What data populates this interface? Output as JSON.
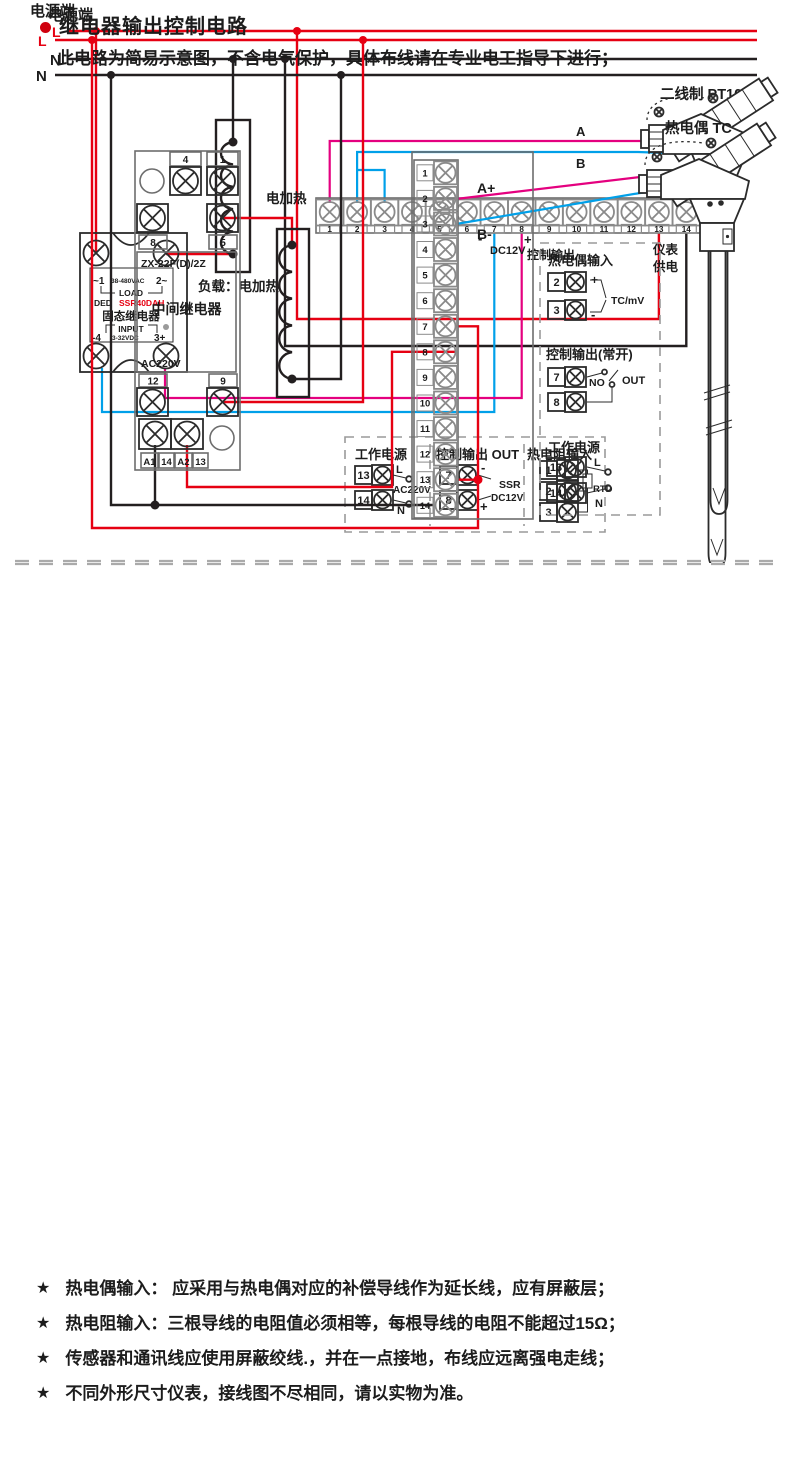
{
  "colors": {
    "live_wire": "#e60012",
    "neutral_wire": "#231f20",
    "plus_wire": "#e4007f",
    "minus_wire": "#00a0e9",
    "model_text": "#e60012",
    "bullet": "#cf000e"
  },
  "diagram1": {
    "power_label": "电源端",
    "line_l": "L",
    "line_n": "N",
    "ssr": {
      "t1": "~1",
      "volt": "38-480VAC",
      "t2": "2~",
      "load": "LOAD",
      "ded": "DED",
      "model": "SSR40DAH",
      "name": "固态继电器",
      "input": "INPUT",
      "t4": "-4",
      "vdc": "3-32VDC",
      "t3": "3+"
    },
    "load_label": "负载：电加热",
    "sensor_label": "二线制 PT100",
    "wire_a": "A",
    "wire_b": "B",
    "minus": "-",
    "plus": "+",
    "dc12v": "DC12V",
    "ctrl_label": "控制输出",
    "meter_supply_1": "仪表",
    "meter_supply_2": "供电",
    "terminals": [
      "1",
      "2",
      "3",
      "4",
      "5",
      "6",
      "7",
      "8",
      "9",
      "10",
      "11",
      "12",
      "13",
      "14"
    ],
    "legend": {
      "title_power": "工作电源",
      "t13": "13",
      "t14": "14",
      "l": "L",
      "n": "N",
      "ac": "AC220V",
      "title_out": "控制输出 OUT",
      "t7": "7",
      "t8": "8",
      "minus": "-",
      "plus": "+",
      "ssr": "SSR",
      "dc12v": "DC12V",
      "title_rtd": "热电阻输入",
      "t1": "1",
      "t2": "2",
      "t3": "3",
      "rtd": "RTD"
    }
  },
  "section2_header": {
    "title": "继电器输出控制电路",
    "subtitle": "此电路为简易示意图，不含电气保护，具体布线请在专业电工指导下进行；"
  },
  "diagram2": {
    "power_label": "电源端",
    "line_l": "L",
    "line_n": "N",
    "relay": {
      "t4": "4",
      "t1": "1",
      "t8": "8",
      "t5": "5",
      "model": "ZX-22F(D)/2Z",
      "name": "中间继电器",
      "volt": "AC220V",
      "t12": "12",
      "t9": "9",
      "a1": "A1",
      "t14": "14",
      "a2": "A2",
      "t13": "13"
    },
    "heater_label": "电加热",
    "a_plus": "A+",
    "b_minus": "B-",
    "sensor_label": "热电偶 TC",
    "terminals": [
      "1",
      "2",
      "3",
      "4",
      "5",
      "6",
      "7",
      "8",
      "9",
      "10",
      "11",
      "12",
      "13",
      "14"
    ],
    "legend": {
      "title_tc": "热电偶输入",
      "t2": "2",
      "t3": "3",
      "plus": "+",
      "minus": "-",
      "tcmv": "TC/mV",
      "title_out": "控制输出(常开)",
      "t7": "7",
      "t8": "8",
      "no": "NO",
      "out": "OUT",
      "title_power": "工作电源",
      "t13": "13",
      "t14": "14",
      "l": "L",
      "n": "N"
    }
  },
  "notes": {
    "star": "★",
    "items": [
      "热电偶输入： 应采用与热电偶对应的补偿导线作为延长线，应有屏蔽层；",
      "热电阻输入：三根导线的电阻值必须相等，每根导线的电阻不能超过15Ω；",
      "传感器和通讯线应使用屏蔽绞线.，并在一点接地，布线应远离强电走线；",
      "不同外形尺寸仪表，接线图不尽相同，请以实物为准。"
    ]
  }
}
